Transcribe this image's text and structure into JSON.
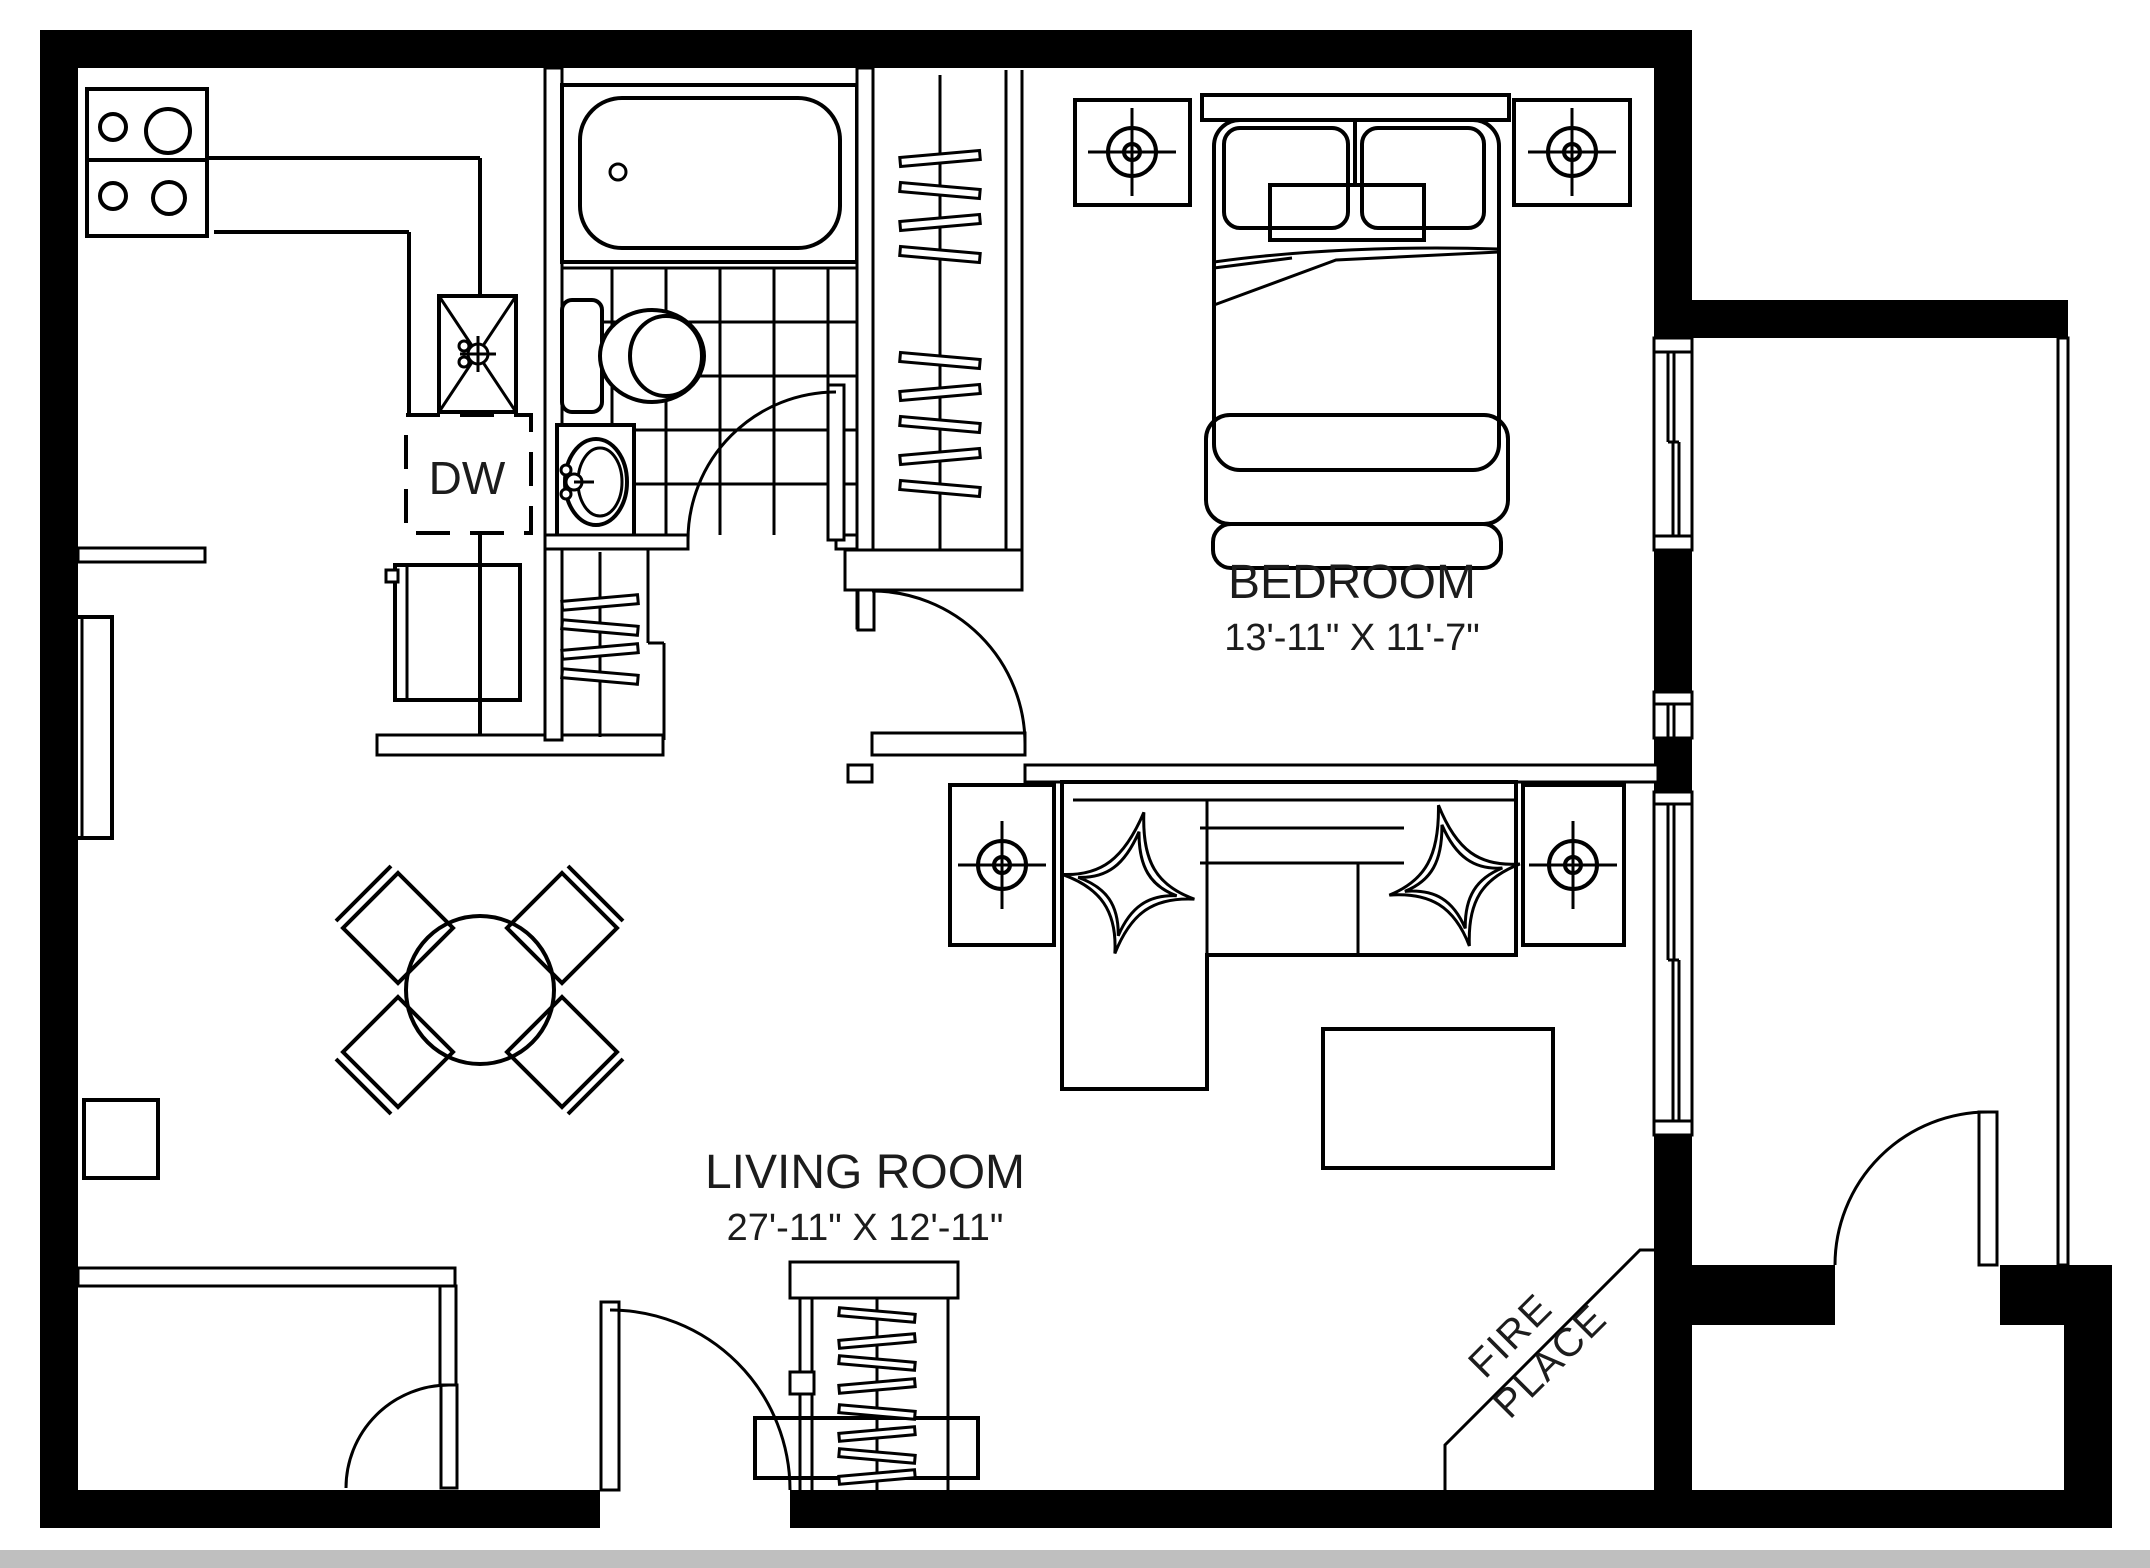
{
  "page": {
    "type": "apartment floor plan drawing",
    "background_color": "#ffffff",
    "line_color": "#000000",
    "bottom_edge_strip_color": "#bfbfbf"
  },
  "labels": {
    "bedroom": {
      "name": "BEDROOM",
      "dimensions": "13'-11\" X 11'-7\""
    },
    "living_room": {
      "name": "LIVING ROOM",
      "dimensions": "27'-11\" X 12'-11\""
    },
    "dishwasher": "DW",
    "fireplace": {
      "line1": "FIRE",
      "line2": "PLACE"
    }
  },
  "fixtures": [
    "stove-4-burners",
    "kitchen-counter",
    "kitchen-sink",
    "dishwasher",
    "refrigerator",
    "bathtub",
    "toilet",
    "bathroom-vanity-sink",
    "bathroom-tile-floor",
    "bedroom-closet-hangers",
    "hall-closet-hangers",
    "entry-closet-hangers",
    "double-bed",
    "nightstand-left",
    "nightstand-right",
    "table-lamp-symbols",
    "sectional-sofa",
    "star-pillows",
    "end-tables",
    "coffee-table",
    "tv-console",
    "round-dining-table",
    "four-dining-chairs",
    "radiators",
    "fireplace-corner",
    "balcony-railing",
    "swing-doors",
    "windows"
  ]
}
